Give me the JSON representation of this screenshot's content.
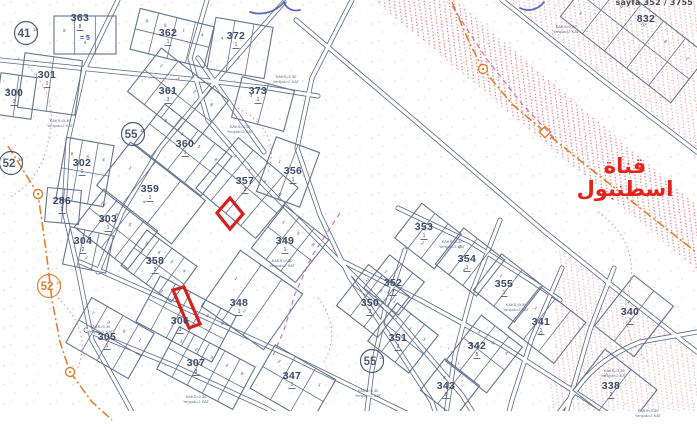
{
  "meta": {
    "page_ref": "sayfa 352 / 3755"
  },
  "canal_label": {
    "text": "قناة اسطنبول",
    "color": "#e3241d"
  },
  "map": {
    "colors": {
      "parcel_line": "#64748e",
      "road_line": "#5a6a84",
      "label": "#3c4a68",
      "lot": "#46536e",
      "note": "#5b6a85",
      "hatch": "#dd6a72",
      "orange": "#e0812f",
      "red_highlight": "#d81f1f",
      "magenta": "#c45ba6",
      "ink_blue": "#3b4fae"
    },
    "zoning_note_lines": [
      "KAKS=0.30",
      "Yençok=2 KAT"
    ],
    "note_positions": [
      [
        286,
        78
      ],
      [
        240,
        128
      ],
      [
        60,
        122
      ],
      [
        100,
        328
      ],
      [
        196,
        398
      ],
      [
        282,
        262
      ],
      [
        368,
        392
      ],
      [
        452,
        243
      ],
      [
        516,
        306
      ],
      [
        614,
        372
      ],
      [
        648,
        412
      ],
      [
        566,
        28
      ]
    ],
    "roads": [
      {
        "name": "main-diagonal",
        "d": "M296,20 L420,125 L545,232 L615,288 L697,352"
      },
      {
        "name": "topright",
        "d": "M502,0 L600,78 L697,152"
      },
      {
        "name": "left-curve",
        "d": "M118,0 L84,70 L68,140 L64,210 L78,270 L92,340 L120,390 L140,427"
      },
      {
        "name": "central",
        "d": "M207,0 L190,58 L208,120 L262,183 L330,252 L398,320 L462,395 L482,427"
      },
      {
        "name": "cross-upper",
        "d": "M284,2 L218,78 L160,148 L122,212 L98,272"
      },
      {
        "name": "mid-diagonal",
        "d": "M352,0 L312,78 L297,148 L320,215 L350,278 L392,340 L432,402 L440,427"
      },
      {
        "name": "lower-1",
        "d": "M80,262 L180,306 L290,356 L396,408 L436,427"
      },
      {
        "name": "lower-2",
        "d": "M86,330 L170,364 L264,407 L300,427"
      },
      {
        "name": "south-parallel",
        "d": "M344,262 L420,300 L500,344 L572,390 L628,427"
      },
      {
        "name": "row-street",
        "d": "M398,208 L470,242 L530,280 L560,300"
      },
      {
        "name": "cross-p1",
        "d": "M405,250 L385,310 L372,370 L365,427"
      },
      {
        "name": "cross-p2",
        "d": "M500,220 L472,292 L455,355 L444,427"
      },
      {
        "name": "cross-p3",
        "d": "M562,268 L532,338 L512,400 L505,427"
      },
      {
        "name": "cross-p4",
        "d": "M614,268 L590,330 L572,392 L562,427"
      },
      {
        "name": "bend-se",
        "d": "M548,427 L580,385 Q600,358 640,342 L697,332"
      },
      {
        "name": "top-row",
        "d": "M0,60 L118,72 L200,80 L268,88 L318,96"
      },
      {
        "name": "top-短",
        "d": "M198,58 L234,110 L264,152"
      }
    ],
    "blocks": [
      {
        "id": "363",
        "cx": 85,
        "cy": 35,
        "w": 62,
        "h": 38,
        "angle": 0,
        "subdiv": 2,
        "split": false,
        "lots": [
          "8",
          "4"
        ],
        "sub": "8",
        "label_at": [
          80,
          17
        ]
      },
      {
        "id": "362",
        "cx": 172,
        "cy": 38,
        "w": 76,
        "h": 42,
        "angle": 14,
        "subdiv": 3,
        "split": true,
        "lots": [
          "6",
          "5",
          "1",
          "4"
        ],
        "sub": "1",
        "label_at": [
          168,
          32
        ]
      },
      {
        "id": "372",
        "cx": 240,
        "cy": 48,
        "w": 58,
        "h": 52,
        "angle": 10,
        "subdiv": 2,
        "split": false,
        "lots": [
          "4",
          "2"
        ],
        "sub": "1",
        "label_at": [
          236,
          35
        ]
      },
      {
        "id": "373",
        "cx": 263,
        "cy": 104,
        "w": 54,
        "h": 42,
        "angle": 15,
        "subdiv": 1,
        "split": false,
        "lots": [
          "1"
        ],
        "sub": "1",
        "label_at": [
          258,
          90
        ]
      },
      {
        "id": "361",
        "cx": 178,
        "cy": 96,
        "w": 85,
        "h": 55,
        "angle": 38,
        "subdiv": 3,
        "split": true,
        "lots": [
          "1",
          "3",
          "2",
          "8"
        ],
        "sub": "3",
        "label_at": [
          168,
          90
        ]
      },
      {
        "id": "301",
        "cx": 50,
        "cy": 84,
        "w": 58,
        "h": 55,
        "angle": 8,
        "subdiv": 1,
        "split": false,
        "lots": [
          "1"
        ],
        "sub": "1",
        "label_at": [
          47,
          74
        ]
      },
      {
        "id": "300",
        "cx": 16,
        "cy": 96,
        "w": 36,
        "h": 42,
        "angle": 8,
        "subdiv": 1,
        "split": false,
        "lots": [
          "3"
        ],
        "sub": "3",
        "label_at": [
          14,
          92
        ]
      },
      {
        "id": "360",
        "cx": 183,
        "cy": 150,
        "w": 85,
        "h": 50,
        "angle": 38,
        "subdiv": 3,
        "split": true,
        "lots": [
          "3",
          "1",
          "5",
          "8"
        ],
        "sub": "1",
        "label_at": [
          185,
          143
        ]
      },
      {
        "id": "302",
        "cx": 85,
        "cy": 172,
        "w": 48,
        "h": 62,
        "angle": 10,
        "subdiv": 2,
        "split": true,
        "lots": [
          "8",
          "6",
          "4"
        ],
        "sub": "1",
        "label_at": [
          82,
          162
        ]
      },
      {
        "id": "286",
        "cx": 63,
        "cy": 206,
        "w": 34,
        "h": 34,
        "angle": 5,
        "subdiv": 1,
        "split": false,
        "lots": [
          "1"
        ],
        "sub": "1",
        "label_at": [
          62,
          200
        ]
      },
      {
        "id": "359",
        "cx": 151,
        "cy": 193,
        "w": 95,
        "h": 55,
        "angle": 38,
        "subdiv": 2,
        "split": false,
        "lots": [
          "1",
          "4"
        ],
        "sub": "1",
        "label_at": [
          150,
          188
        ]
      },
      {
        "id": "303",
        "cx": 116,
        "cy": 229,
        "w": 68,
        "h": 48,
        "angle": 38,
        "subdiv": 3,
        "split": true,
        "lots": [
          "14",
          "8",
          "5"
        ],
        "sub": "1",
        "label_at": [
          108,
          218
        ]
      },
      {
        "id": "304",
        "cx": 88,
        "cy": 250,
        "w": 44,
        "h": 38,
        "angle": 12,
        "subdiv": 2,
        "split": false,
        "lots": [
          "3",
          "2"
        ],
        "sub": "2",
        "label_at": [
          83,
          240
        ]
      },
      {
        "id": "358",
        "cx": 159,
        "cy": 266,
        "w": 62,
        "h": 44,
        "angle": 36,
        "subdiv": 3,
        "split": true,
        "lots": [
          "5",
          "6",
          "3",
          "4"
        ],
        "sub": "3",
        "label_at": [
          155,
          260
        ]
      },
      {
        "id": "305",
        "cx": 110,
        "cy": 338,
        "w": 72,
        "h": 52,
        "angle": 30,
        "subdiv": 3,
        "split": true,
        "lots": [
          "7",
          "3",
          "6",
          "1"
        ],
        "sub": "1",
        "label_at": [
          107,
          336
        ]
      },
      {
        "id": "306",
        "cx": 186,
        "cy": 319,
        "w": 86,
        "h": 52,
        "angle": 28,
        "subdiv": 4,
        "split": true,
        "lots": [
          "2",
          "5",
          "7",
          "3",
          "6"
        ],
        "sub": "3",
        "label_at": [
          180,
          320
        ]
      },
      {
        "id": "307",
        "cx": 206,
        "cy": 368,
        "w": 86,
        "h": 48,
        "angle": 28,
        "subdiv": 4,
        "split": true,
        "lots": [
          "1",
          "2",
          "3",
          "4",
          "8"
        ],
        "sub": "3",
        "label_at": [
          196,
          362
        ]
      },
      {
        "id": "347",
        "cx": 293,
        "cy": 384,
        "w": 70,
        "h": 50,
        "angle": 30,
        "subdiv": 2,
        "split": true,
        "lots": [
          "2",
          "4",
          "1"
        ],
        "sub": "1",
        "label_at": [
          292,
          375
        ]
      },
      {
        "id": "348",
        "cx": 252,
        "cy": 300,
        "w": 76,
        "h": 68,
        "angle": 35,
        "subdiv": 2,
        "split": false,
        "lots": [
          "1",
          "2"
        ],
        "sub": "1",
        "label_at": [
          239,
          302
        ]
      },
      {
        "id": "357",
        "cx": 247,
        "cy": 188,
        "w": 78,
        "h": 66,
        "angle": 40,
        "subdiv": 3,
        "split": true,
        "lots": [
          "7",
          "2",
          "6",
          "8"
        ],
        "sub": "2",
        "label_at": [
          245,
          180
        ]
      },
      {
        "id": "356",
        "cx": 288,
        "cy": 172,
        "w": 46,
        "h": 58,
        "angle": 20,
        "subdiv": 1,
        "split": false,
        "lots": [
          "1"
        ],
        "sub": "1",
        "label_at": [
          293,
          170
        ]
      },
      {
        "id": "349",
        "cx": 290,
        "cy": 244,
        "w": 56,
        "h": 54,
        "angle": 38,
        "subdiv": 2,
        "split": true,
        "lots": [
          "1",
          "5",
          "8"
        ],
        "sub": "1",
        "label_at": [
          285,
          240
        ]
      },
      {
        "id": "350",
        "cx": 373,
        "cy": 301,
        "w": 52,
        "h": 52,
        "angle": 38,
        "subdiv": 2,
        "split": true,
        "lots": [
          "2",
          "3",
          "1"
        ],
        "sub": "2",
        "label_at": [
          370,
          302
        ]
      },
      {
        "id": "351",
        "cx": 403,
        "cy": 338,
        "w": 52,
        "h": 48,
        "angle": 38,
        "subdiv": 2,
        "split": true,
        "lots": [
          "2",
          "1",
          "3"
        ],
        "sub": "2",
        "label_at": [
          398,
          337
        ]
      },
      {
        "id": "352",
        "cx": 394,
        "cy": 285,
        "w": 44,
        "h": 42,
        "angle": 38,
        "subdiv": 2,
        "split": false,
        "lots": [
          "7",
          "1"
        ],
        "sub": "7",
        "label_at": [
          393,
          282
        ]
      },
      {
        "id": "353",
        "cx": 428,
        "cy": 236,
        "w": 50,
        "h": 44,
        "angle": 38,
        "subdiv": 2,
        "split": false,
        "lots": [
          "1",
          "2"
        ],
        "sub": "1",
        "label_at": [
          424,
          226
        ]
      },
      {
        "id": "354",
        "cx": 470,
        "cy": 262,
        "w": 52,
        "h": 46,
        "angle": 38,
        "subdiv": 2,
        "split": false,
        "lots": [
          "1",
          "3"
        ],
        "sub": "1",
        "label_at": [
          467,
          258
        ]
      },
      {
        "id": "355",
        "cx": 508,
        "cy": 288,
        "w": 52,
        "h": 46,
        "angle": 38,
        "subdiv": 1,
        "split": false,
        "lots": [
          "1"
        ],
        "sub": "1",
        "label_at": [
          504,
          283
        ]
      },
      {
        "id": "342",
        "cx": 484,
        "cy": 354,
        "w": 52,
        "h": 58,
        "angle": 38,
        "subdiv": 2,
        "split": true,
        "lots": [
          "5",
          "3",
          "4"
        ],
        "sub": "5",
        "label_at": [
          477,
          345
        ]
      },
      {
        "id": "343",
        "cx": 450,
        "cy": 388,
        "w": 44,
        "h": 40,
        "angle": 38,
        "subdiv": 1,
        "split": false,
        "lots": [
          "6"
        ],
        "sub": "6",
        "label_at": [
          446,
          385
        ]
      },
      {
        "id": "341",
        "cx": 547,
        "cy": 325,
        "w": 58,
        "h": 52,
        "angle": 38,
        "subdiv": 2,
        "split": false,
        "lots": [
          "1",
          "11"
        ],
        "sub": "1",
        "label_at": [
          541,
          321
        ]
      },
      {
        "id": "340",
        "cx": 634,
        "cy": 316,
        "w": 50,
        "h": 64,
        "angle": 38,
        "subdiv": 1,
        "split": false,
        "lots": [
          "1"
        ],
        "sub": "1",
        "label_at": [
          630,
          311
        ]
      },
      {
        "id": "338",
        "cx": 615,
        "cy": 390,
        "w": 66,
        "h": 52,
        "angle": 38,
        "subdiv": 1,
        "split": false,
        "lots": [
          "2"
        ],
        "sub": "2",
        "label_at": [
          611,
          385
        ]
      },
      {
        "id": "832",
        "cx": 634,
        "cy": 36,
        "w": 140,
        "h": 60,
        "angle": 38,
        "subdiv": 4,
        "split": true,
        "lots": [
          "7",
          "9",
          "10",
          "8",
          "2",
          "5"
        ],
        "sub": "",
        "label_at": [
          646,
          18
        ]
      }
    ],
    "markers": [
      {
        "text": "41",
        "sup": "10",
        "x": 26,
        "y": 33,
        "tone": "blue"
      },
      {
        "text": "52",
        "sup": "10",
        "x": 11,
        "y": 163,
        "tone": "blue"
      },
      {
        "text": "52",
        "sup": "10",
        "x": 49,
        "y": 286,
        "tone": "orange"
      },
      {
        "text": "55",
        "sup": "10",
        "x": 133,
        "y": 134,
        "tone": "blue"
      },
      {
        "text": "55",
        "sup": "10",
        "x": 372,
        "y": 361,
        "tone": "blue"
      }
    ],
    "red_parcels": [
      {
        "points": "230,198 243,214 230,229 217,213"
      },
      {
        "points": "173,290 184,287 200,324 189,328"
      }
    ],
    "boundaries": [
      {
        "d": "M8,146 L38,194 L46,250 L52,300 L60,342 L70,372 L92,402 L112,420",
        "nodes": [
          {
            "x": 38,
            "y": 194,
            "shape": "circle"
          },
          {
            "x": 70,
            "y": 372,
            "shape": "circle"
          }
        ]
      },
      {
        "d": "M452,2 L470,44 L483,69 L512,104 L545,132 L582,162 L640,208 L696,252",
        "nodes": [
          {
            "x": 483,
            "y": 69,
            "shape": "circle"
          },
          {
            "x": 545,
            "y": 132,
            "shape": "diamond"
          }
        ]
      }
    ],
    "magenta_lines": [
      {
        "d": "M340,213 L312,256 L295,294 L284,330 L272,358"
      },
      {
        "d": "M452,6 L486,58 L522,104 L556,140"
      }
    ],
    "hatch_zones": [
      {
        "points": "374,0 455,0 697,205 697,270",
        "opacity": 0.9
      },
      {
        "points": "505,0 697,0 697,148",
        "opacity": 0.55
      },
      {
        "points": "560,240 697,348 697,412 548,412",
        "opacity": 0.5
      }
    ],
    "contours": [
      {
        "d": "M18,58 Q62,92 48,142 Q40,182 8,198"
      },
      {
        "d": "M238,108 Q282,132 268,172"
      },
      {
        "d": "M598,212 Q642,244 628,292 Q618,332 648,362"
      },
      {
        "d": "M318,298 Q342,330 324,362"
      },
      {
        "d": "M58,298 Q92,330 78,368"
      },
      {
        "d": "M448,348 Q470,372 458,398"
      }
    ],
    "ink_marks": [
      {
        "d": "M250,12 C262,16 276,12 284,2"
      },
      {
        "d": "M284,2 C286,8 292,12 300,10"
      },
      {
        "d": "M520,8 C528,12 538,10 544,2"
      }
    ],
    "ink_note": {
      "text": "= 5",
      "x": 80,
      "y": 40
    }
  }
}
